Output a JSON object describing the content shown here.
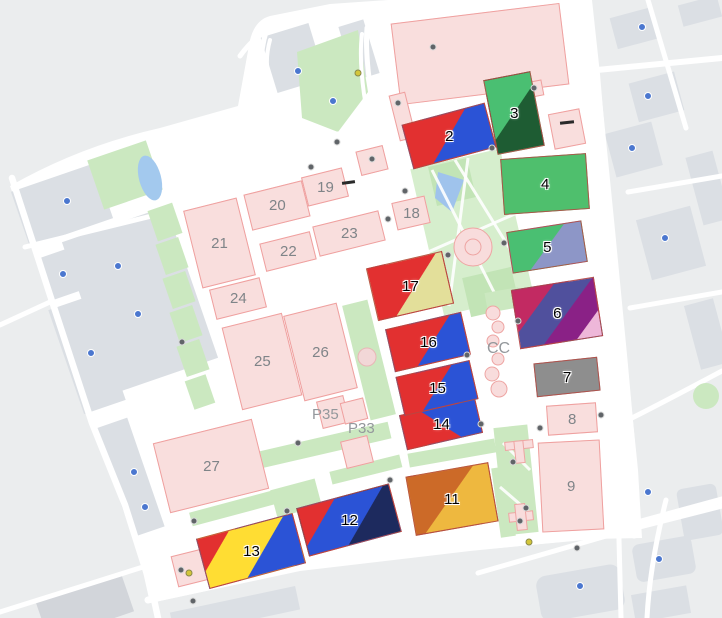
{
  "map": {
    "halls": {
      "h2": "2",
      "h3": "3",
      "h4": "4",
      "h5": "5",
      "h6": "6",
      "h7": "7",
      "h8": "8",
      "h9": "9",
      "h11": "11",
      "h12": "12",
      "h13": "13",
      "h14": "14",
      "h15": "15",
      "h16": "16",
      "h17": "17",
      "h18": "18",
      "h19": "19",
      "h20": "20",
      "h21": "21",
      "h22": "22",
      "h23": "23",
      "h24": "24",
      "h25": "25",
      "h26": "26",
      "h27": "27"
    },
    "area_labels": {
      "cc": "CC",
      "p33": "P33",
      "p35": "P35"
    },
    "colors": {
      "red": "#e23030",
      "blue": "#2b53d6",
      "navy": "#1d2a5e",
      "yellow": "#ffdd33",
      "khaki": "#e3df9a",
      "orange": "#cc6a28",
      "amber": "#eeb83f",
      "green_light": "#4abf72",
      "green_dark": "#1e5c33",
      "green_mid": "#4fbf6d",
      "slate_purple": "#8d96c7",
      "crimson": "#c22a62",
      "indigo": "#50509d",
      "purple": "#8a2186",
      "pink_stripe": "#eeb7d9",
      "hall_gray": "#8e8e8e",
      "hall_pink": "#f9dedd",
      "hall_pink_border": "#efa09f",
      "park_green": "#cbe8c0",
      "water_blue": "#9fc3ec",
      "background": "#ebedee",
      "parcel_gray": "#dbdfe4"
    },
    "poi_dots": [
      {
        "x": 67,
        "y": 201,
        "t": "b"
      },
      {
        "x": 63,
        "y": 274,
        "t": "b"
      },
      {
        "x": 118,
        "y": 266,
        "t": "b"
      },
      {
        "x": 138,
        "y": 314,
        "t": "b"
      },
      {
        "x": 91,
        "y": 353,
        "t": "b"
      },
      {
        "x": 298,
        "y": 71,
        "t": "b"
      },
      {
        "x": 333,
        "y": 101,
        "t": "b"
      },
      {
        "x": 134,
        "y": 472,
        "t": "b"
      },
      {
        "x": 145,
        "y": 507,
        "t": "b"
      },
      {
        "x": 642,
        "y": 27,
        "t": "b"
      },
      {
        "x": 648,
        "y": 96,
        "t": "b"
      },
      {
        "x": 632,
        "y": 148,
        "t": "b"
      },
      {
        "x": 665,
        "y": 238,
        "t": "b"
      },
      {
        "x": 580,
        "y": 586,
        "t": "b"
      },
      {
        "x": 659,
        "y": 559,
        "t": "b"
      },
      {
        "x": 648,
        "y": 492,
        "t": "b"
      },
      {
        "x": 433,
        "y": 47,
        "t": "g"
      },
      {
        "x": 534,
        "y": 88,
        "t": "g"
      },
      {
        "x": 398,
        "y": 103,
        "t": "g"
      },
      {
        "x": 492,
        "y": 148,
        "t": "g"
      },
      {
        "x": 372,
        "y": 159,
        "t": "g"
      },
      {
        "x": 405,
        "y": 191,
        "t": "g"
      },
      {
        "x": 388,
        "y": 219,
        "t": "g"
      },
      {
        "x": 311,
        "y": 167,
        "t": "g"
      },
      {
        "x": 337,
        "y": 142,
        "t": "g"
      },
      {
        "x": 448,
        "y": 255,
        "t": "g"
      },
      {
        "x": 467,
        "y": 355,
        "t": "g"
      },
      {
        "x": 481,
        "y": 424,
        "t": "g"
      },
      {
        "x": 504,
        "y": 243,
        "t": "g"
      },
      {
        "x": 518,
        "y": 321,
        "t": "g"
      },
      {
        "x": 540,
        "y": 428,
        "t": "g"
      },
      {
        "x": 601,
        "y": 415,
        "t": "g"
      },
      {
        "x": 513,
        "y": 462,
        "t": "g"
      },
      {
        "x": 520,
        "y": 521,
        "t": "g"
      },
      {
        "x": 526,
        "y": 508,
        "t": "g"
      },
      {
        "x": 194,
        "y": 521,
        "t": "g"
      },
      {
        "x": 287,
        "y": 511,
        "t": "g"
      },
      {
        "x": 390,
        "y": 480,
        "t": "g"
      },
      {
        "x": 298,
        "y": 443,
        "t": "g"
      },
      {
        "x": 182,
        "y": 342,
        "t": "g"
      },
      {
        "x": 181,
        "y": 570,
        "t": "g"
      },
      {
        "x": 193,
        "y": 601,
        "t": "g"
      },
      {
        "x": 577,
        "y": 548,
        "t": "g"
      },
      {
        "x": 358,
        "y": 73,
        "t": "y"
      },
      {
        "x": 529,
        "y": 542,
        "t": "y"
      },
      {
        "x": 189,
        "y": 573,
        "t": "y"
      }
    ]
  }
}
